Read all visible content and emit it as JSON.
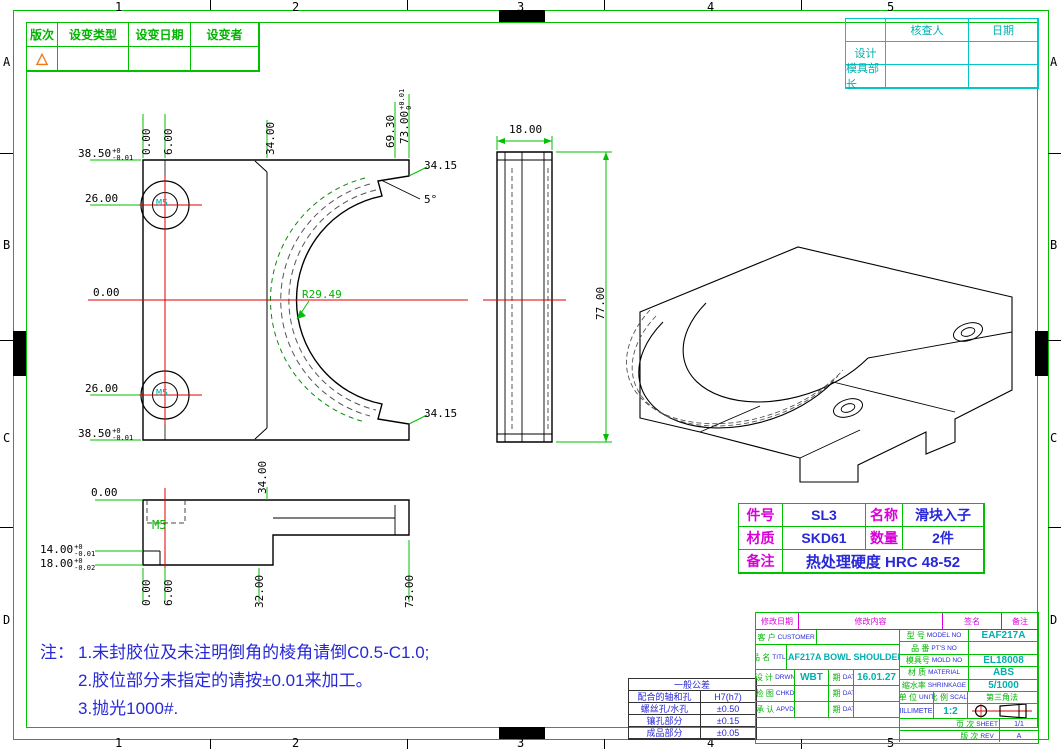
{
  "colors": {
    "green": "#00C000",
    "cyan": "#00C8C8",
    "magenta": "#D800D8",
    "blue": "#2828D8",
    "red": "#E00000",
    "orange": "#F07818"
  },
  "zones": {
    "h": [
      "1",
      "2",
      "3",
      "4",
      "5"
    ],
    "v": [
      "A",
      "B",
      "C",
      "D"
    ]
  },
  "revision_table": {
    "headers": [
      "版次",
      "设变类型",
      "设变日期",
      "设变者"
    ],
    "symbol": "△"
  },
  "approval_table": {
    "r1c2": "核查人",
    "r1c3": "日期",
    "r2c1": "设计",
    "r3c1": "模具部长"
  },
  "part_table": {
    "l1": "件号",
    "v1": "SL3",
    "l2": "名称",
    "v2": "滑块入子",
    "l3": "材质",
    "v3": "SKD61",
    "l4": "数量",
    "v4": "2件",
    "l5": "备注",
    "v5": "热处理硬度 HRC 48-52"
  },
  "notes": {
    "label": "注：",
    "line1": "1.未封胶位及未注明倒角的棱角请倒C0.5-C1.0;",
    "line2": "2.胶位部分未指定的请按±0.01来加工。",
    "line3": "3.抛光1000#."
  },
  "front_view": {
    "top_dims": {
      "d0": "0.00",
      "d6": "6.00",
      "d34": "34.00",
      "d69": "69.30",
      "d73": "73.00",
      "d73_up": "+0.01",
      "d73_dn": "0"
    },
    "left_dims": {
      "d385a": "38.50",
      "d385a_up": "+0",
      "d385a_dn": "-0.01",
      "d26a": "26.00",
      "d0": "0.00",
      "d26b": "26.00",
      "d385b": "38.50",
      "d385b_up": "+0",
      "d385b_dn": "-0.01"
    },
    "right_dims": {
      "d3415a": "34.15",
      "angle": "5°",
      "d3415b": "34.15"
    },
    "radius": "R29.49",
    "m5_top": "M5",
    "m5_bottom": "M5"
  },
  "side_view": {
    "width": "18.00",
    "height": "77.00"
  },
  "bottom_view": {
    "d0_top": "0.00",
    "d34": "34.00",
    "m5": "M5",
    "d14": "14.00",
    "d14_up": "+0",
    "d14_dn": "-0.01",
    "d18": "18.00",
    "d18_up": "+0",
    "d18_dn": "-0.02",
    "b0": "0.00",
    "b6": "6.00",
    "b32": "32.00",
    "b73": "73.00"
  },
  "tolerance_table": {
    "title": "一般公差",
    "r1l": "配合的轴和孔",
    "r1v": "H7(h7)",
    "r2l": "螺丝孔/水孔",
    "r2v": "±0.50",
    "r3l": "镶孔部分",
    "r3v": "±0.15",
    "r4l": "成品部分",
    "r4v": "±0.05"
  },
  "title_block": {
    "hdr1": "修改日期",
    "hdr2": "修改内容",
    "hdr3": "签名",
    "hdr4": "备注",
    "customer_zh": "客 户",
    "customer_en": "CUSTOMER",
    "customer_val": "",
    "title_zh": "品 名",
    "title_en": "TITLE",
    "title_val": "EAF217A BOWL SHOULDER",
    "drwn_zh": "设 计",
    "drwn_en": "DRWN",
    "drwn_val": "WBT",
    "date_zh": "日 期",
    "date_en": "DATE",
    "drwn_date": "16.01.27",
    "chkd_zh": "检 图",
    "chkd_en": "CHKD",
    "chkd_val": "",
    "chkd_date": "",
    "apvd_zh": "承 认",
    "apvd_en": "APVD",
    "apvd_val": "",
    "apvd_date": "",
    "model_zh": "型 号",
    "model_en": "MODEL NO",
    "model_val": "EAF217A",
    "pts_zh": "品 番",
    "pts_en": "PT'S NO",
    "pts_val": "",
    "mold_zh": "模具号",
    "mold_en": "MOLD NO",
    "mold_val": "EL18008",
    "mat_zh": "材 质",
    "mat_en": "MATERIAL",
    "mat_val": "ABS",
    "shrink_zh": "缩水率",
    "shrink_en": "SHRINKAGE",
    "shrink_val": "5/1000",
    "unit_zh": "单 位",
    "unit_en": "UNIT",
    "unit_val": "MILLIMETER",
    "scale_zh": "比 例",
    "scale_en": "SCALE",
    "scale_val": "1:2",
    "proj_zh": "第三角法",
    "sheet_zh": "页 次",
    "sheet_en": "SHEET",
    "sheet_val": "1/1",
    "rev_zh": "版 次",
    "rev_en": "REV",
    "rev_val": "A"
  }
}
